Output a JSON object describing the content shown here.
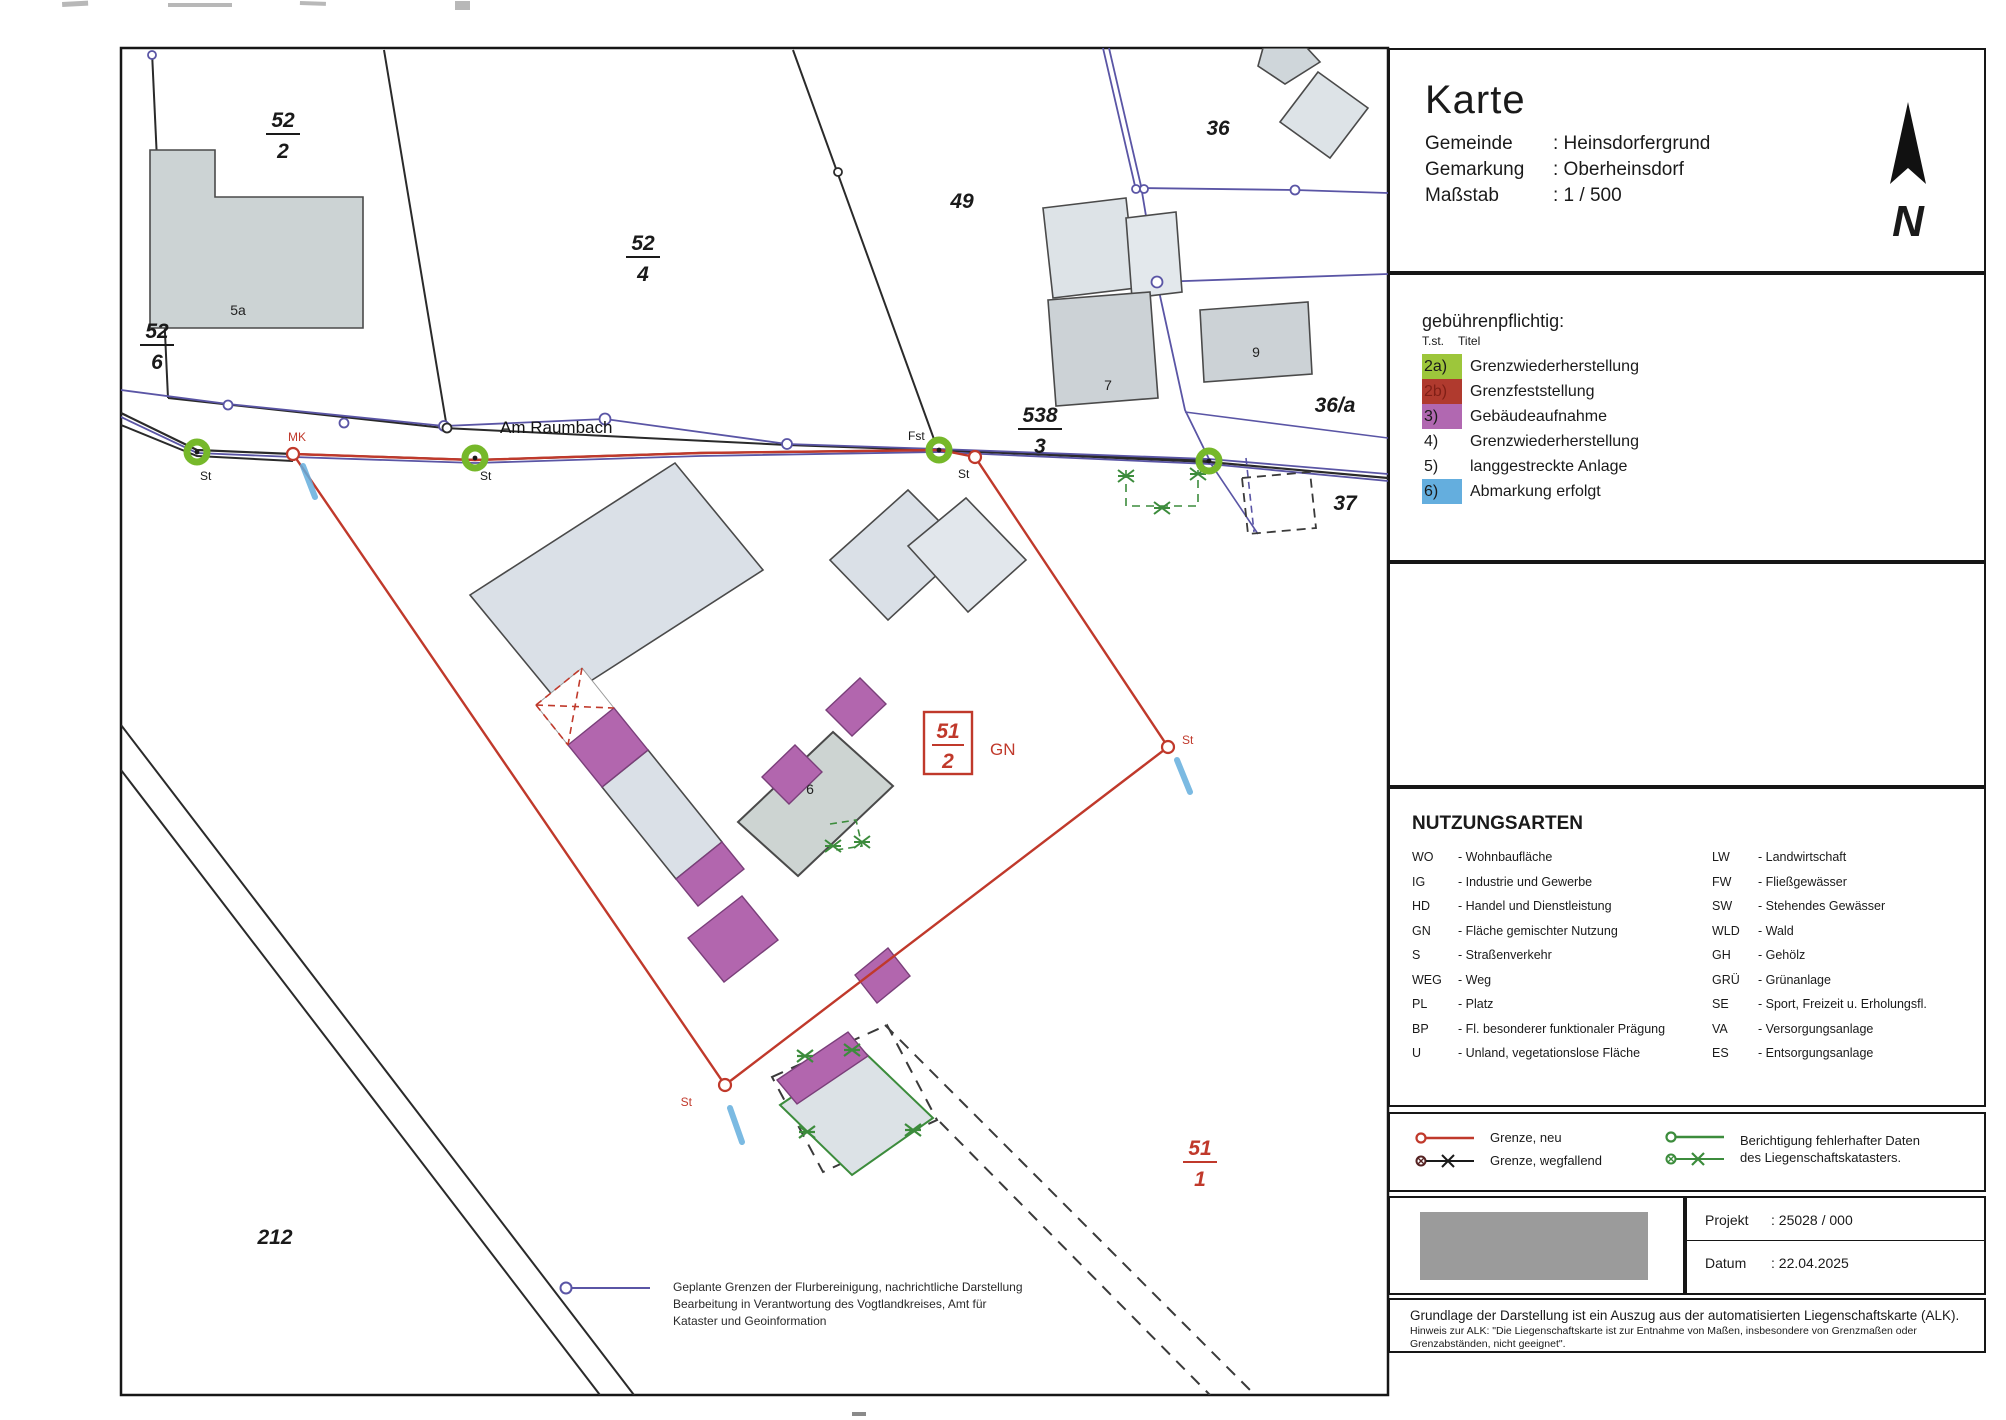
{
  "colors": {
    "boundary_new": "#c0392b",
    "cadastre_line": "#5a55a5",
    "building_capture_purple": "#b266ae",
    "abmarkung_blue": "#64aede",
    "correction_green": "#3c8c3c",
    "survey_point_green": "#76b82a",
    "building_gray": "#d9dfe4"
  },
  "title_block": {
    "title": "Karte",
    "rows": [
      {
        "label": "Gemeinde",
        "value": ": Heinsdorfergrund"
      },
      {
        "label": "Gemarkung",
        "value": ": Oberheinsdorf"
      },
      {
        "label": "Maßstab",
        "value": ": 1 / 500"
      }
    ],
    "north_letter": "N"
  },
  "fee_legend": {
    "heading": "gebührenpflichtig:",
    "col_header_1": "T.st.",
    "col_header_2": "Titel",
    "items": [
      {
        "tst": "2a)",
        "title": "Grenzwiederherstellung"
      },
      {
        "tst": "2b)",
        "title": "Grenzfeststellung"
      },
      {
        "tst": "3)",
        "title": "Gebäudeaufnahme"
      },
      {
        "tst": "4)",
        "title": "Grenzwiederherstellung"
      },
      {
        "tst": "5)",
        "title": "langgestreckte Anlage"
      },
      {
        "tst": "6)",
        "title": "Abmarkung erfolgt"
      }
    ]
  },
  "nutzungsarten": {
    "heading": "NUTZUNGSARTEN",
    "left": [
      {
        "abbr": "WO",
        "def": "- Wohnbaufläche"
      },
      {
        "abbr": "IG",
        "def": "- Industrie und Gewerbe"
      },
      {
        "abbr": "HD",
        "def": "- Handel und Dienstleistung"
      },
      {
        "abbr": "GN",
        "def": "- Fläche gemischter Nutzung"
      },
      {
        "abbr": "S",
        "def": "- Straßenverkehr"
      },
      {
        "abbr": "WEG",
        "def": "- Weg"
      },
      {
        "abbr": "PL",
        "def": "- Platz"
      },
      {
        "abbr": "BP",
        "def": "- Fl. besonderer funktionaler Prägung"
      },
      {
        "abbr": "U",
        "def": "- Unland, vegetationslose Fläche"
      }
    ],
    "right": [
      {
        "abbr": "LW",
        "def": "- Landwirtschaft"
      },
      {
        "abbr": "FW",
        "def": "- Fließgewässer"
      },
      {
        "abbr": "SW",
        "def": "- Stehendes Gewässer"
      },
      {
        "abbr": "WLD",
        "def": "- Wald"
      },
      {
        "abbr": "GH",
        "def": "- Gehölz"
      },
      {
        "abbr": "GRÜ",
        "def": "- Grünanlage"
      },
      {
        "abbr": "SE",
        "def": "- Sport, Freizeit u. Erholungsfl."
      },
      {
        "abbr": "VA",
        "def": "- Versorgungsanlage"
      },
      {
        "abbr": "ES",
        "def": "- Entsorgungsanlage"
      }
    ]
  },
  "boundary_legend": {
    "grenze_neu": "Grenze, neu",
    "grenze_wegfallend": "Grenze, wegfallend",
    "berichtigung_line1": "Berichtigung fehlerhafter Daten",
    "berichtigung_line2": "des Liegenschaftskatasters."
  },
  "project_block": {
    "rows": [
      {
        "label": "Projekt",
        "value": ": 25028 / 000"
      },
      {
        "label": "Datum",
        "value": ": 22.04.2025"
      }
    ]
  },
  "footer": {
    "main": "Grundlage der Darstellung ist ein Auszug aus der automatisierten Liegenschaftskarte (ALK).",
    "note_line1": "Hinweis zur ALK: \"Die Liegenschaftskarte ist zur Entnahme von Maßen, insbesondere von Grenzmaßen oder",
    "note_line2": "Grenzabständen, nicht geeignet\"."
  },
  "map": {
    "street_name": "Am Raumbach",
    "fractions": {
      "f52_2": {
        "num": "52",
        "den": "2"
      },
      "f52_4": {
        "num": "52",
        "den": "4"
      },
      "f52_6": {
        "num": "52",
        "den": "6"
      },
      "f538_3": {
        "num": "538",
        "den": "3"
      },
      "f51_2": {
        "num": "51",
        "den": "2"
      },
      "f51_1": {
        "num": "51",
        "den": "1"
      }
    },
    "parcel_labels": {
      "p49": "49",
      "p36": "36",
      "p36a": "36/a",
      "p37": "37",
      "p212": "212"
    },
    "building_labels": {
      "b5a": "5a",
      "b7": "7",
      "b9": "9",
      "b6": "6"
    },
    "point_labels": {
      "mk": "MK",
      "st": "St",
      "fst": "Fst"
    },
    "usage_label": "GN",
    "annotation": {
      "line1": "Geplante Grenzen der Flurbereinigung, nachrichtliche Darstellung",
      "line2": "Bearbeitung in Verantwortung des Vogtlandkreises, Amt für",
      "line3": "Kataster und Geoinformation"
    }
  }
}
